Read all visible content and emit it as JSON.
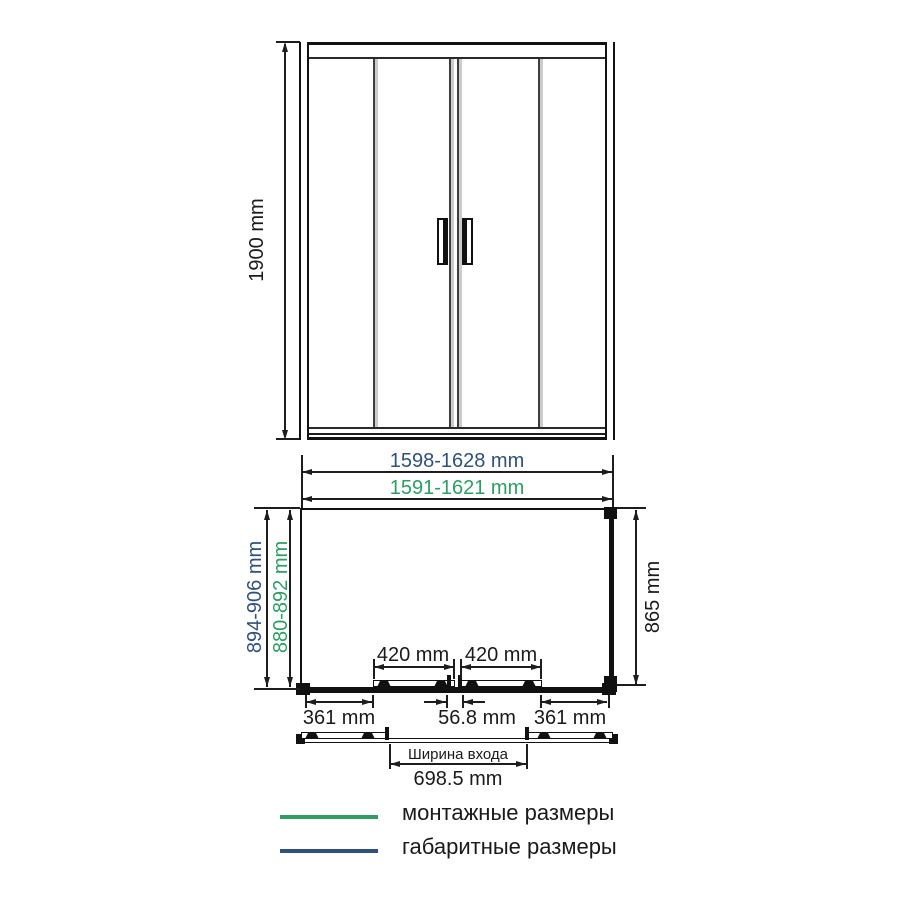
{
  "diagram": {
    "title_semantics": "shower enclosure dimension drawing",
    "front_view": {
      "height_dim": "1900 mm"
    },
    "top_view": {
      "overall_width_dim": "1598-1628 mm",
      "mounting_width_dim": "1591-1621 mm",
      "overall_depth_dim": "894-906 mm",
      "mounting_depth_dim": "880-892 mm",
      "side_depth_dim": "865 mm",
      "door_panel_dim_left": "420 mm",
      "door_panel_dim_right": "420 mm",
      "side_section_dim_left": "361 mm",
      "side_section_dim_right": "361 mm",
      "center_overlap_dim": "56.8 mm",
      "entrance_caption": "Ширина входа",
      "entrance_width_dim": "698.5 mm"
    },
    "legend": {
      "items": [
        {
          "label": "монтажные размеры",
          "color": "#2e9e63"
        },
        {
          "label": "габаритные размеры",
          "color": "#31517c"
        }
      ]
    },
    "colors": {
      "mounting_green": "#2e9e63",
      "overall_navy": "#31517c",
      "drawing_line": "#1d1d1d"
    }
  }
}
